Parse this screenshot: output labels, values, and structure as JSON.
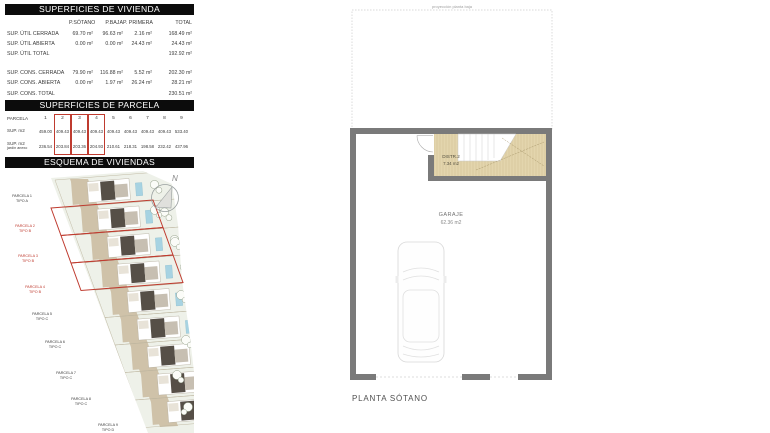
{
  "tables": {
    "vivienda": {
      "title": "SUPERFICIES DE VIVIENDA",
      "columns": [
        "P.SÓTANO",
        "P.BAJA",
        "P. PRIMERA",
        "TOTAL"
      ],
      "rows": [
        {
          "label": "SUP. ÚTIL CERRADA",
          "values": [
            "69.70 m²",
            "96.63 m²",
            "2.16 m²",
            "168.49 m²"
          ]
        },
        {
          "label": "SUP. ÚTIL ABIERTA",
          "values": [
            "0.00 m²",
            "0.00 m²",
            "24.43 m²",
            "24.43 m²"
          ]
        },
        {
          "label": "SUP. ÚTIL TOTAL",
          "values": [
            "",
            "",
            "",
            "192.92 m²"
          ]
        },
        {
          "label": "SUP. CONS. CERRADA",
          "values": [
            "79.90 m²",
            "116.88 m²",
            "5.52 m²",
            "202.30 m²"
          ]
        },
        {
          "label": "SUP. CONS. ABIERTA",
          "values": [
            "0.00 m²",
            "1.97 m²",
            "26.24 m²",
            "28.21 m²"
          ]
        },
        {
          "label": "SUP. CONS. TOTAL",
          "values": [
            "",
            "",
            "",
            "230.51 m²"
          ]
        }
      ]
    },
    "parcela": {
      "title": "SUPERFICIES DE PARCELA",
      "row_labels": {
        "r1": "PARCELA",
        "r2": "SUP. m2",
        "r3_line1": "SUP. m2",
        "r3_line2": "jardín anexo"
      },
      "numbers": [
        "1",
        "2",
        "3",
        "4",
        "5",
        "6",
        "7",
        "8",
        "9"
      ],
      "sup": [
        "459.00",
        "409.43",
        "409.43",
        "409.43",
        "409.43",
        "409.43",
        "409.43",
        "409.43",
        "533.40"
      ],
      "jardin": [
        "236.54",
        "203.84",
        "203.36",
        "204.93",
        "210.61",
        "218.31",
        "198.58",
        "232.42",
        "437.96"
      ],
      "highlighted_parcels": [
        2,
        3,
        4
      ]
    }
  },
  "esquema": {
    "title": "ESQUEMA DE VIVIENDAS",
    "north_label": "N",
    "parcels": [
      {
        "name": "PARCELA 1",
        "tipo": "TIPO A",
        "highlighted": false
      },
      {
        "name": "PARCELA 2",
        "tipo": "TIPO B",
        "highlighted": true
      },
      {
        "name": "PARCELA 3",
        "tipo": "TIPO B",
        "highlighted": true
      },
      {
        "name": "PARCELA 4",
        "tipo": "TIPO B",
        "highlighted": true
      },
      {
        "name": "PARCELA 5",
        "tipo": "TIPO C",
        "highlighted": false
      },
      {
        "name": "PARCELA 6",
        "tipo": "TIPO C",
        "highlighted": false
      },
      {
        "name": "PARCELA 7",
        "tipo": "TIPO C",
        "highlighted": false
      },
      {
        "name": "PARCELA 8",
        "tipo": "TIPO C",
        "highlighted": false
      },
      {
        "name": "PARCELA 9",
        "tipo": "TIPO D",
        "highlighted": false
      }
    ]
  },
  "plan": {
    "projection_label": "proyección planta baja",
    "rooms": [
      {
        "name": "DISTR.2",
        "area": "7.34 m2"
      },
      {
        "name": "GARAJE",
        "area": "62.36 m2"
      }
    ],
    "title": "PLANTA SÓTANO"
  },
  "colors": {
    "accent_red": "#bf3b2f",
    "wall_gray": "#7a7a7a",
    "room_tan": "#e3d5ad",
    "pool_blue": "#a7d3e2",
    "terrain_green": "#eef1e9",
    "header_black": "#0c0c0c"
  }
}
